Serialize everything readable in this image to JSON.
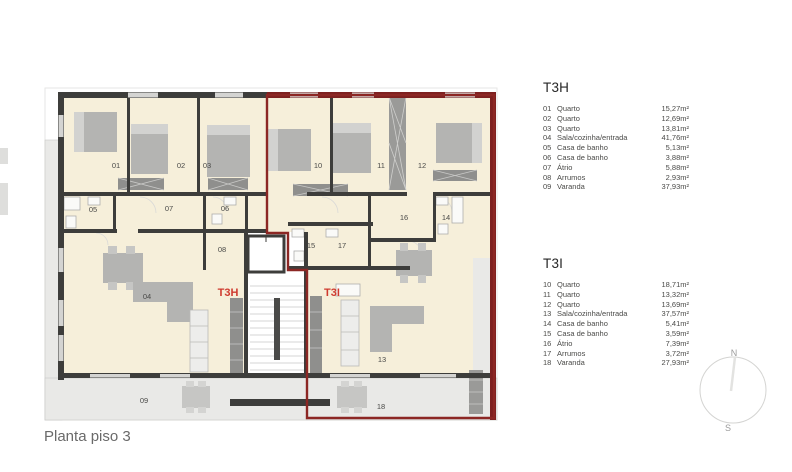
{
  "page": {
    "title": "Planta piso 3"
  },
  "legends": [
    {
      "title": "T3H",
      "items": [
        {
          "num": "01",
          "name": "Quarto",
          "area": "15,27m²"
        },
        {
          "num": "02",
          "name": "Quarto",
          "area": "12,69m²"
        },
        {
          "num": "03",
          "name": "Quarto",
          "area": "13,81m²"
        },
        {
          "num": "04",
          "name": "Sala/cozinha/entrada",
          "area": "41,76m²"
        },
        {
          "num": "05",
          "name": "Casa de banho",
          "area": "5,13m²"
        },
        {
          "num": "06",
          "name": "Casa de banho",
          "area": "3,88m²"
        },
        {
          "num": "07",
          "name": "Átrio",
          "area": "5,88m²"
        },
        {
          "num": "08",
          "name": "Arrumos",
          "area": "2,93m²"
        },
        {
          "num": "09",
          "name": "Varanda",
          "area": "37,93m²"
        }
      ]
    },
    {
      "title": "T3I",
      "items": [
        {
          "num": "10",
          "name": "Quarto",
          "area": "18,71m²"
        },
        {
          "num": "11",
          "name": "Quarto",
          "area": "13,32m²"
        },
        {
          "num": "12",
          "name": "Quarto",
          "area": "13,69m²"
        },
        {
          "num": "13",
          "name": "Sala/cozinha/entrada",
          "area": "37,57m²"
        },
        {
          "num": "14",
          "name": "Casa de banho",
          "area": "5,41m²"
        },
        {
          "num": "15",
          "name": "Casa de banho",
          "area": "3,59m²"
        },
        {
          "num": "16",
          "name": "Átrio",
          "area": "7,39m²"
        },
        {
          "num": "17",
          "name": "Arrumos",
          "area": "3,72m²"
        },
        {
          "num": "18",
          "name": "Varanda",
          "area": "27,93m²"
        }
      ]
    }
  ],
  "plan": {
    "unit_labels": [
      {
        "text": "T3H"
      },
      {
        "text": "T3I"
      }
    ],
    "rooms": [
      {
        "num": "01"
      },
      {
        "num": "02"
      },
      {
        "num": "03"
      },
      {
        "num": "04"
      },
      {
        "num": "05"
      },
      {
        "num": "06"
      },
      {
        "num": "07"
      },
      {
        "num": "08"
      },
      {
        "num": "09"
      },
      {
        "num": "10"
      },
      {
        "num": "11"
      },
      {
        "num": "12"
      },
      {
        "num": "13"
      },
      {
        "num": "14"
      },
      {
        "num": "15"
      },
      {
        "num": "16"
      },
      {
        "num": "17"
      },
      {
        "num": "18"
      }
    ]
  },
  "compass": {
    "north": "N",
    "south": "S"
  },
  "colors": {
    "room_fill": "#f6efda",
    "terrace_fill": "#e9e9e7",
    "wall": "#3d3d3b",
    "unit_outline": "#8c2724",
    "unit_label": "#cf3a2e",
    "furniture": "#b4b4b2"
  }
}
